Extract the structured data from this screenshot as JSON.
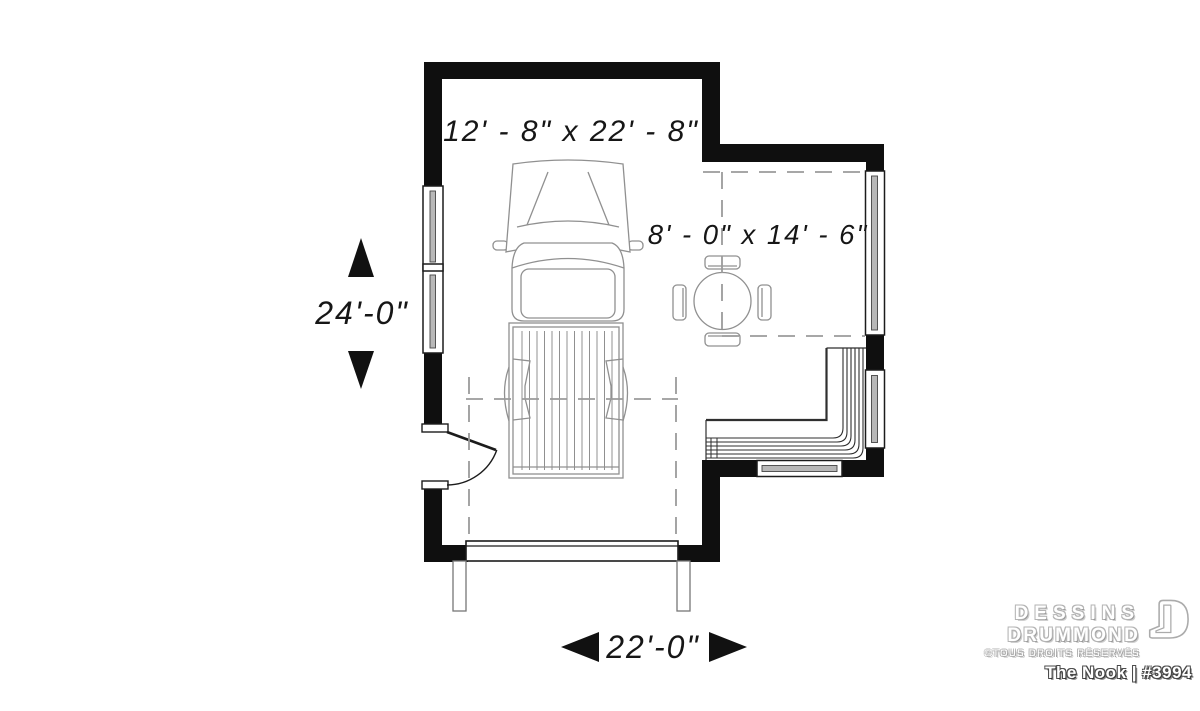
{
  "plan": {
    "garage_dim": "12' - 8\" x 22' - 8\"",
    "nook_dim": "8' - 0\" x 14' - 6\"",
    "depth_dim": "24'-0\"",
    "width_dim": "22'-0\""
  },
  "branding": {
    "studio_line1": "DESSINS",
    "studio_line2": "DRUMMOND",
    "rights": "©TOUS DROITS RÉSERVÉS",
    "plan_title": "The Nook | #3994"
  },
  "icons": {
    "arrow_up": "▲",
    "arrow_down": "▼",
    "arrow_left": "◀",
    "arrow_right": "▶",
    "logo_mark": "drummond-d"
  },
  "colors": {
    "background": "#ffffff",
    "wall": "#0f0f0f",
    "plan_line": "#1c1c1c",
    "furniture_line": "#909090",
    "stair_line": "#2f2f2f",
    "dashed_line": "#9b9b9b",
    "logo_outline": "#a8a8a8",
    "title_outline": "#3a3a3a"
  }
}
